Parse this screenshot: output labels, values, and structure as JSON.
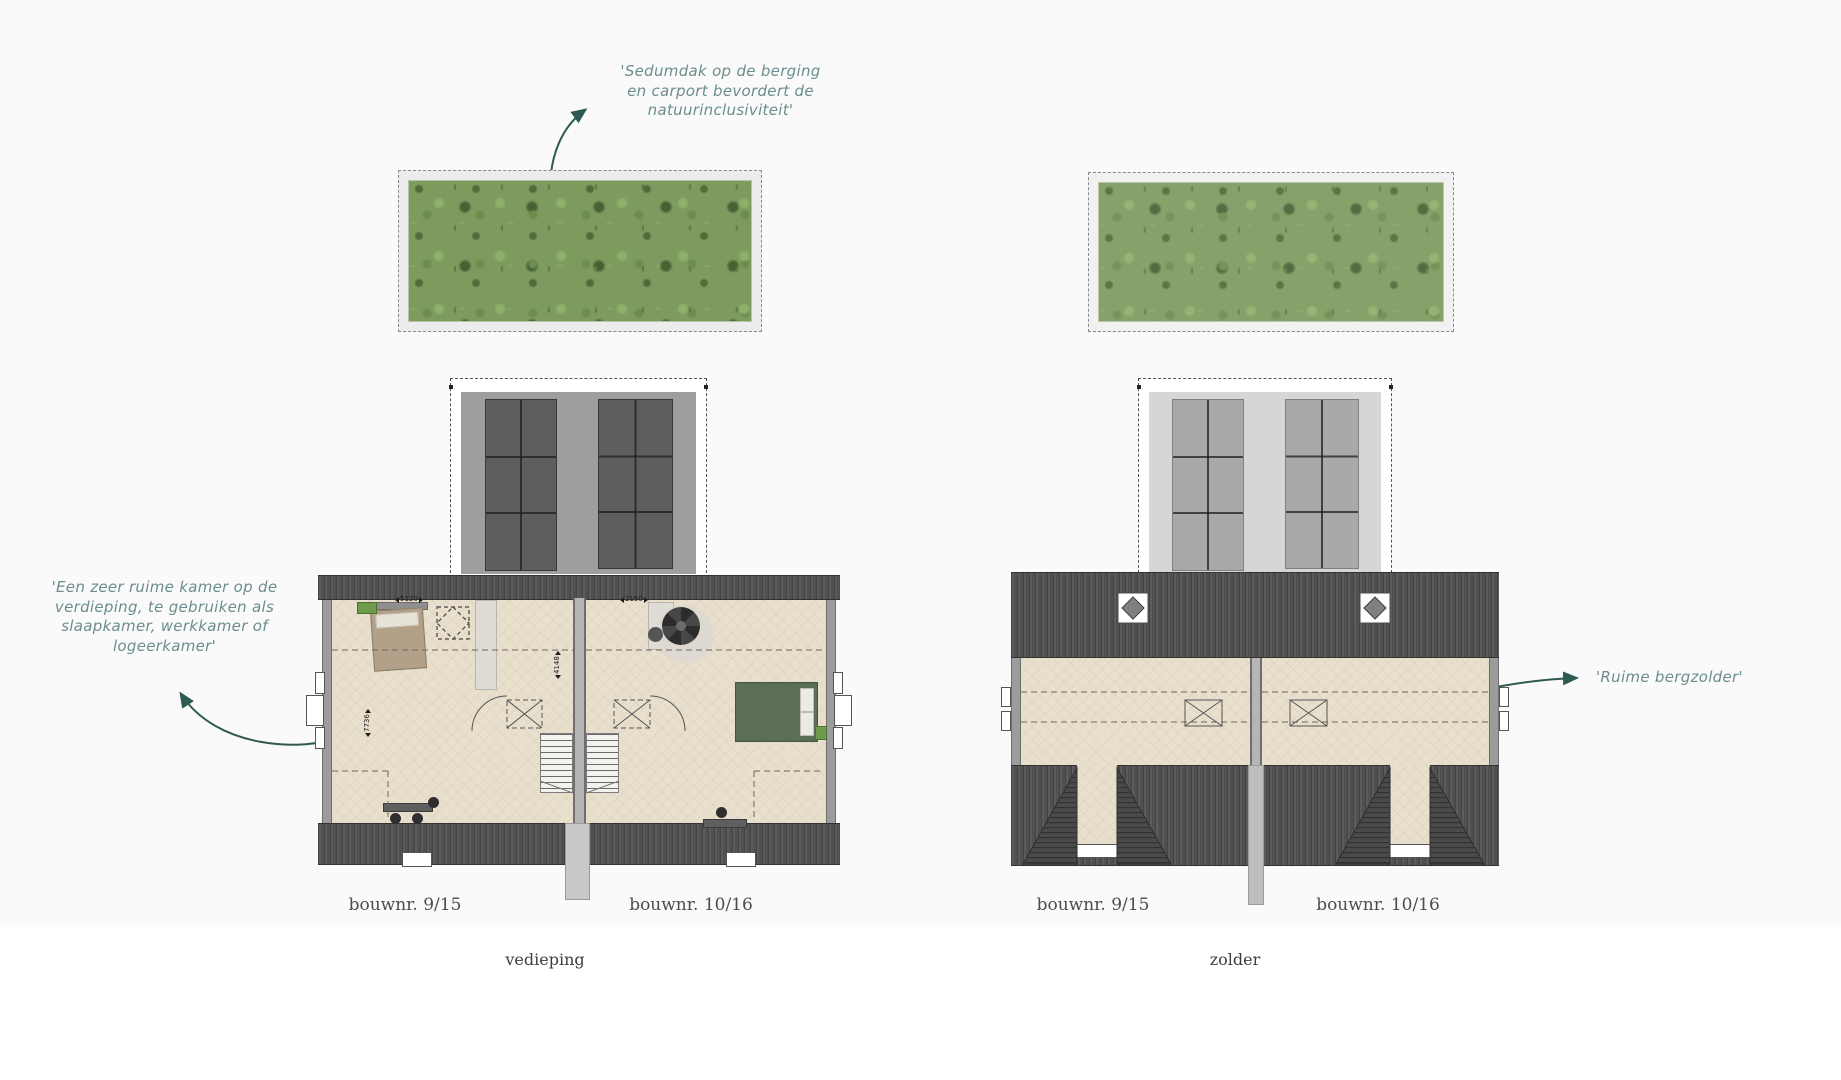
{
  "annotations": {
    "sedum_note": {
      "line1": "'Sedumdak op de berging",
      "line2": "en carport bevordert de",
      "line3": "natuurinclusiviteit'"
    },
    "room_note": {
      "line1": "'Een zeer ruime kamer op de",
      "line2": "verdieping, te gebruiken als",
      "line3": "slaapkamer, werkkamer of",
      "line4": "logeerkamer'"
    },
    "attic_note": {
      "text": "'Ruime bergzolder'"
    }
  },
  "floor_plan": {
    "caption": "vedieping",
    "unit_left_label": "bouwnr. 9/15",
    "unit_right_label": "bouwnr. 10/16",
    "dim_width_left": "5120",
    "dim_width_right": "2150",
    "dim_depth_left": "7736",
    "dim_depth_center": "4148"
  },
  "attic_plan": {
    "caption": "zolder",
    "unit_left_label": "bouwnr. 9/15",
    "unit_right_label": "bouwnr. 10/16"
  },
  "colors": {
    "annotation_text": "#6b8d8d",
    "annotation_arrow": "#2d5a52",
    "label_text": "#4c4c4c",
    "roof_tile_dark": "#505050",
    "floor_beige": "#e9dfcd",
    "sedum_green": "#7d9b5f",
    "dormer_window_dark": "#5e5e5e",
    "dormer_window_light": "#a9a9a9"
  }
}
